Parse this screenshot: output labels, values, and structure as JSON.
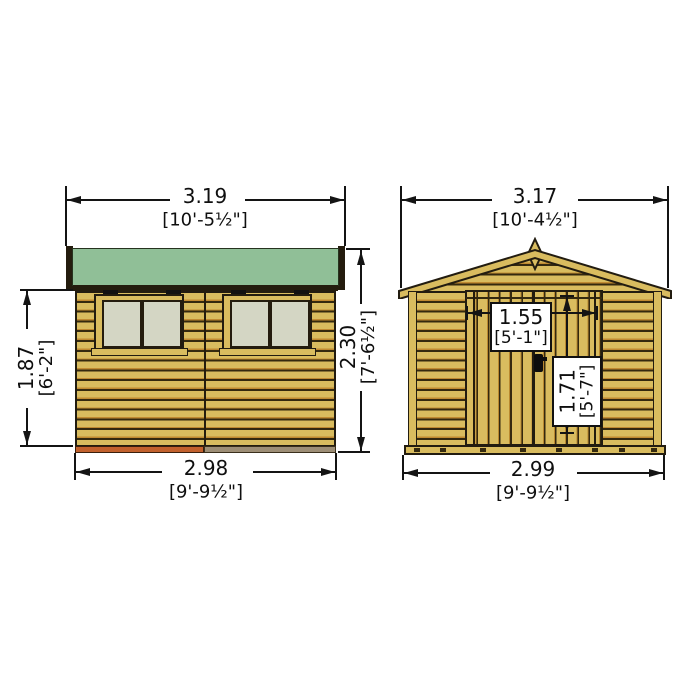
{
  "drawing": {
    "title": "garden shed elevation diagram",
    "views": [
      "side elevation",
      "front elevation"
    ],
    "units": "metres with [feet-inches] conversions"
  },
  "dims": {
    "side_roof_width": {
      "num": "3.19",
      "imp": "[10'-5½\"]"
    },
    "side_wall_height": {
      "num": "1.87",
      "imp": "[6'-2\"]"
    },
    "side_total_height": {
      "num": "2.30",
      "imp": "[7'-6½\"]"
    },
    "side_base_width": {
      "num": "2.98",
      "imp": "[9'-9½\"]"
    },
    "front_roof_width": {
      "num": "3.17",
      "imp": "[10'-4½\"]"
    },
    "front_door_width": {
      "num": "1.55",
      "imp": "[5'-1\"]"
    },
    "front_door_height": {
      "num": "1.71",
      "imp": "[5'-7\"]"
    },
    "front_base_width": {
      "num": "2.99",
      "imp": "[9'-9½\"]"
    }
  },
  "colors": {
    "roof_felt_green": "#90bf97",
    "timber_tan": "#d9bc5f",
    "cladding_shadow": "#c08a32",
    "outline_dark": "#221c10",
    "window_pane": "#d4d6c4",
    "base_bearer_orange": "#c2612d",
    "base_bearer_brown": "#9d8e76",
    "dimension_line": "#141414",
    "label_box": "#ffffff"
  }
}
